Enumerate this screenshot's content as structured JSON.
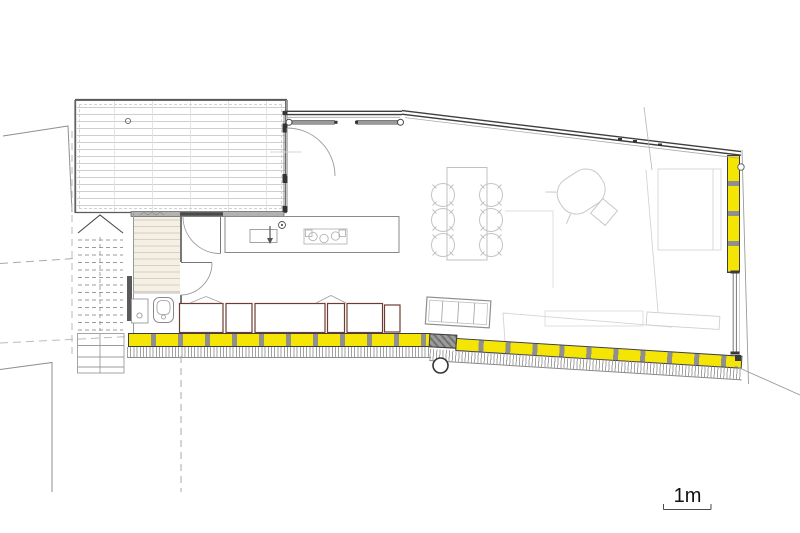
{
  "document": {
    "kind": "architectural floor plan, single storey living level",
    "scale_bar_label": "1m"
  },
  "palette": {
    "background": "#ffffff",
    "insulation_yellow": "#f4e504",
    "separator_gray": "#8f8f8f",
    "wall_dark": "#3f3f3f",
    "cabinet_outline_brown": "#6f3c34",
    "furniture_light_gray": "#c4c4c4",
    "wood_floor_beige": "#d9d1bc",
    "site_line_gray": "#999999"
  },
  "inventory": {
    "dining_chairs": 6,
    "dining_tables": 1,
    "cooktop_burners": 3,
    "sliding_door_panels": 2,
    "bottom_cabinet_segments": 6,
    "bench_sections": 4,
    "stair_treads": 13,
    "doors_with_swing_arcs": 3
  },
  "legend": [
    "timber-deck",
    "exterior-stair",
    "entry-hall",
    "bathroom",
    "toilet",
    "washbasin",
    "kitchen-island",
    "sink",
    "faucet",
    "tap-point",
    "cooktop",
    "dining-table",
    "dining-chair",
    "lounge-chair",
    "bench",
    "low-cabinet-row",
    "insulated-wall-bottom",
    "insulated-wall-right",
    "window-right",
    "sliding-glass-door",
    "sloped-roof-edge",
    "ground-hatch",
    "site-boundary-line",
    "column-marker",
    "scale-bar"
  ]
}
